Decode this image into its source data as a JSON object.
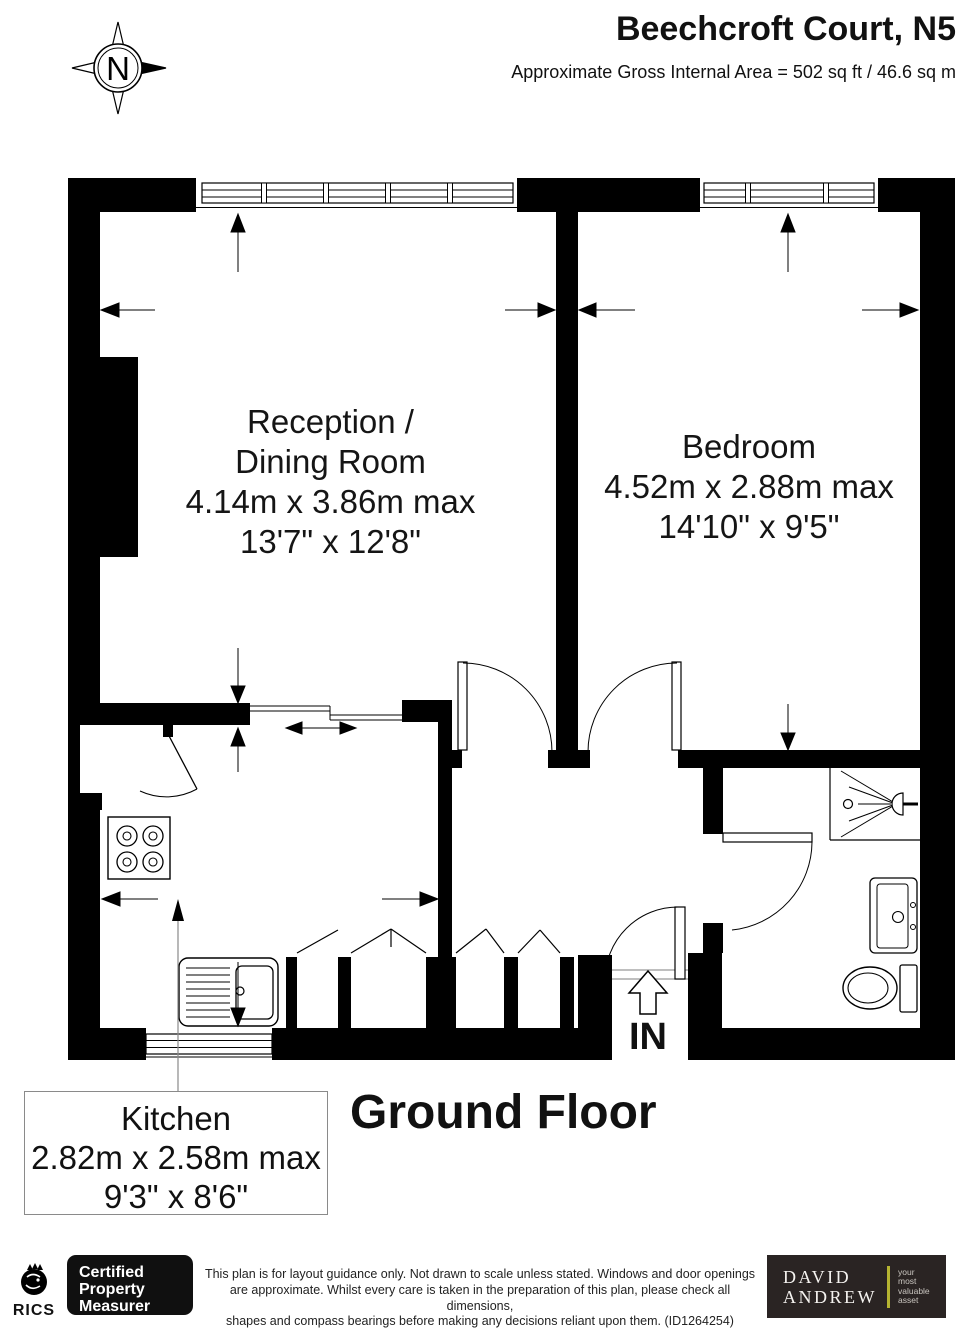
{
  "header": {
    "title": "Beechcroft Court, N5",
    "subtitle": "Approximate Gross Internal Area = 502 sq ft / 46.6 sq m"
  },
  "compass": {
    "label": "N"
  },
  "rooms": {
    "reception": {
      "line1": "Reception /",
      "line2": "Dining Room",
      "metric": "4.14m x 3.86m max",
      "imperial": "13'7\" x 12'8\""
    },
    "bedroom": {
      "name": "Bedroom",
      "metric": "4.52m x 2.88m max",
      "imperial": "14'10\" x 9'5\""
    },
    "kitchen": {
      "name": "Kitchen",
      "metric": "2.82m x 2.58m max",
      "imperial": "9'3\" x 8'6\""
    }
  },
  "floor_label": "Ground Floor",
  "entrance_label": "IN",
  "footer": {
    "rics_label": "RICS",
    "badge_lines": [
      "Certified",
      "Property",
      "Measurer"
    ],
    "disclaimer_lines": [
      "This plan is for layout guidance only. Not drawn to scale unless stated. Windows and door openings",
      "are approximate. Whilst every care is taken in the preparation of this plan, please check all dimensions,",
      "shapes and compass bearings before making any decisions reliant upon them. (ID1264254)"
    ],
    "brand": {
      "line1": "DAVID",
      "line2": "ANDREW",
      "tagline_lines": [
        "your",
        "most",
        "valuable",
        "asset"
      ],
      "accent_color": "#b5b431",
      "bg_color": "#2a2423"
    }
  }
}
